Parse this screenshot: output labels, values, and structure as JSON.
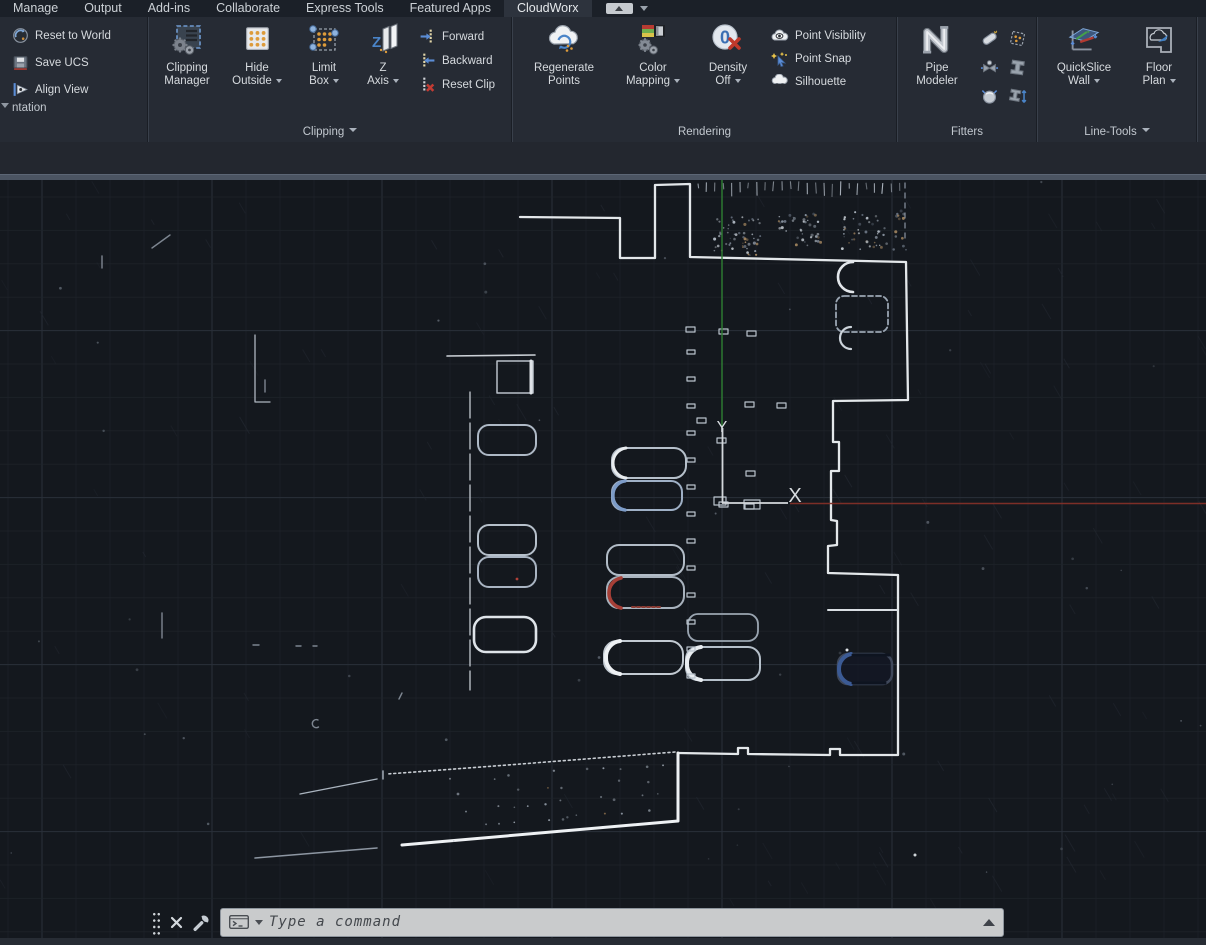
{
  "tabbar": {
    "tabs": [
      "Manage",
      "Output",
      "Add-ins",
      "Collaborate",
      "Express Tools",
      "Featured Apps",
      "CloudWorx"
    ],
    "active_tab": "CloudWorx"
  },
  "ribbon": {
    "orientation": {
      "panel_label": "ntation",
      "reset_world": "Reset to World",
      "save_ucs": "Save UCS",
      "align_view": "Align View"
    },
    "clipping": {
      "panel_label": "Clipping",
      "manager_l1": "Clipping",
      "manager_l2": "Manager",
      "hide_l1": "Hide",
      "hide_l2": "Outside",
      "limit_l1": "Limit",
      "limit_l2": "Box",
      "zaxis_l1": "Z",
      "zaxis_l2": "Axis",
      "forward": "Forward",
      "backward": "Backward",
      "reset_clip": "Reset Clip"
    },
    "rendering": {
      "panel_label": "Rendering",
      "regen_l1": "Regenerate",
      "regen_l2": "Points",
      "color_l1": "Color",
      "color_l2": "Mapping",
      "density_l1": "Density",
      "density_l2": "Off",
      "point_visibility": "Point Visibility",
      "point_snap": "Point Snap",
      "silhouette": "Silhouette"
    },
    "fitters": {
      "panel_label": "Fitters",
      "pipe_l1": "Pipe",
      "pipe_l2": "Modeler"
    },
    "linetools": {
      "panel_label": "Line-Tools",
      "quickslice_l1": "QuickSlice",
      "quickslice_l2": "Wall",
      "floor_l1": "Floor",
      "floor_l2": "Plan"
    }
  },
  "viewport": {
    "ucs_y_label": "Y",
    "ucs_x_label": "X",
    "y_axis_color": "#2e7d32",
    "x_axis_color": "#833028",
    "background": "#14181e"
  },
  "command": {
    "placeholder": "Type a command"
  }
}
